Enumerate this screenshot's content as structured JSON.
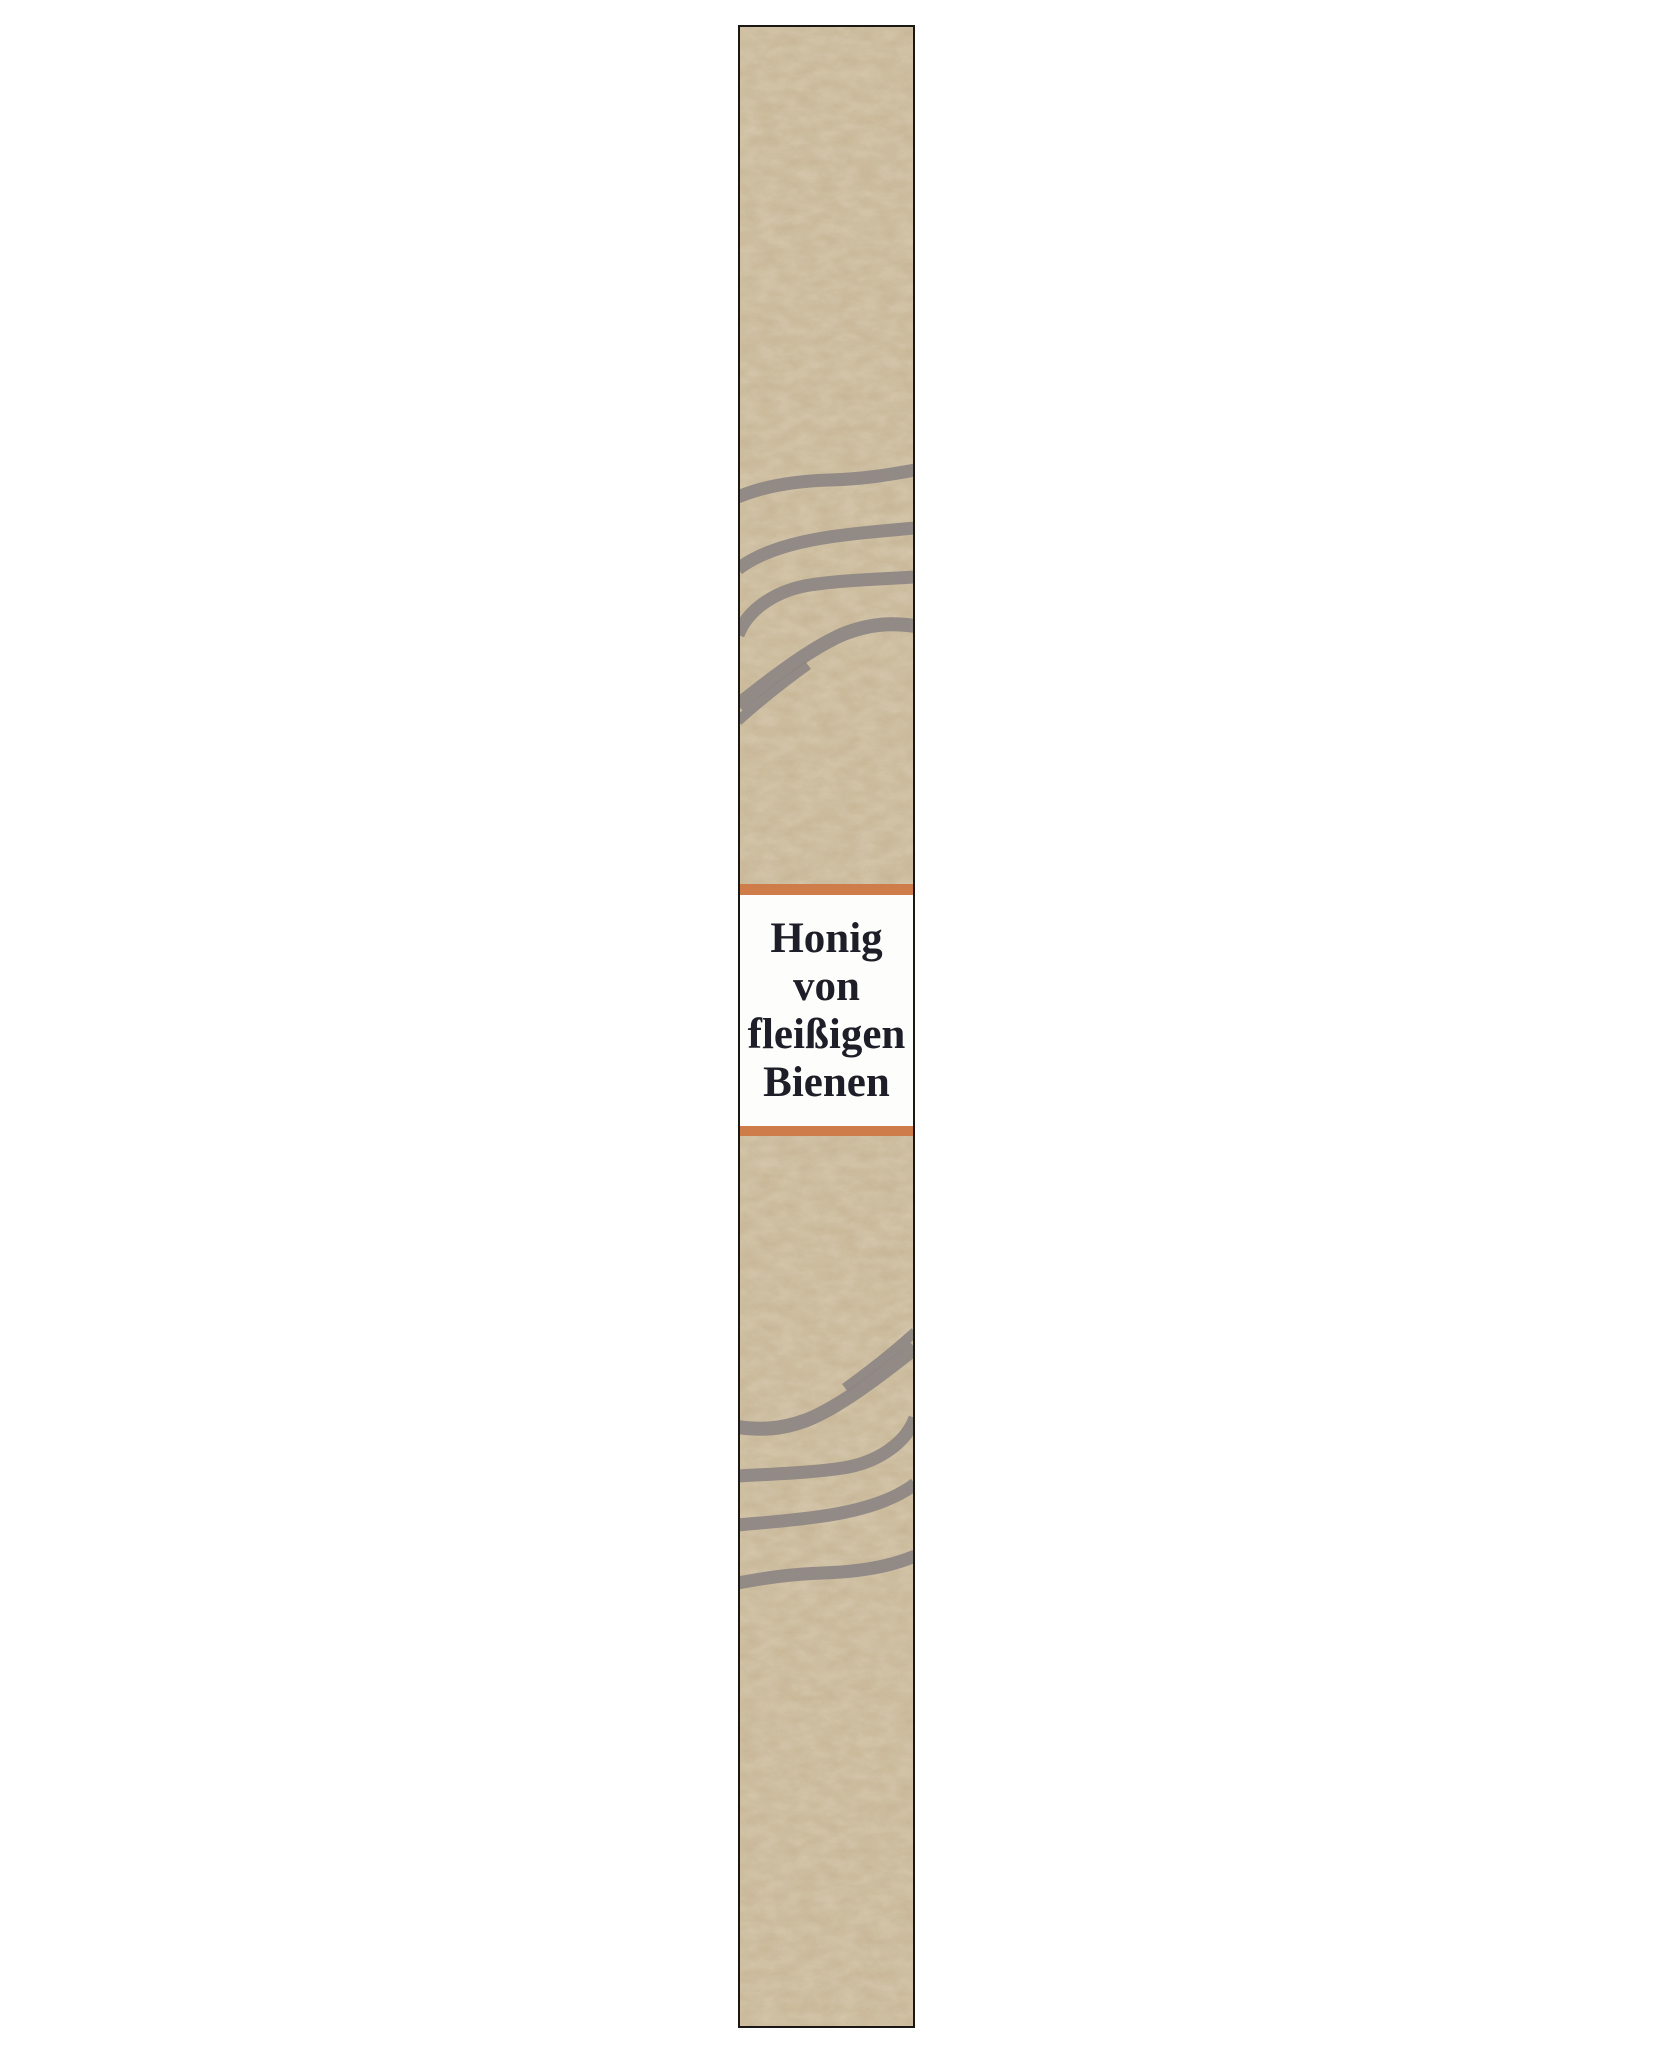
{
  "page": {
    "width": 1654,
    "height": 2055
  },
  "band": {
    "kind": "honey-jar-paper-band",
    "label": {
      "lines": [
        "Honig",
        "von",
        "fleißigen",
        "Bienen"
      ]
    },
    "decorations": {
      "top_waves": "wavy-brush-stroke-group",
      "bottom_waves": "wavy-brush-stroke-group-rotated-180",
      "texture": "mottled-paper-grain"
    }
  },
  "colors": {
    "page_bg": "#ffffff",
    "paper_tan": "#c6b494",
    "wave_gray": "#8d8583",
    "band_orange": "#cd7c4a",
    "border_black": "#1a1814",
    "label_white": "#fdfdfc",
    "text_ink": "#1e1e28"
  }
}
